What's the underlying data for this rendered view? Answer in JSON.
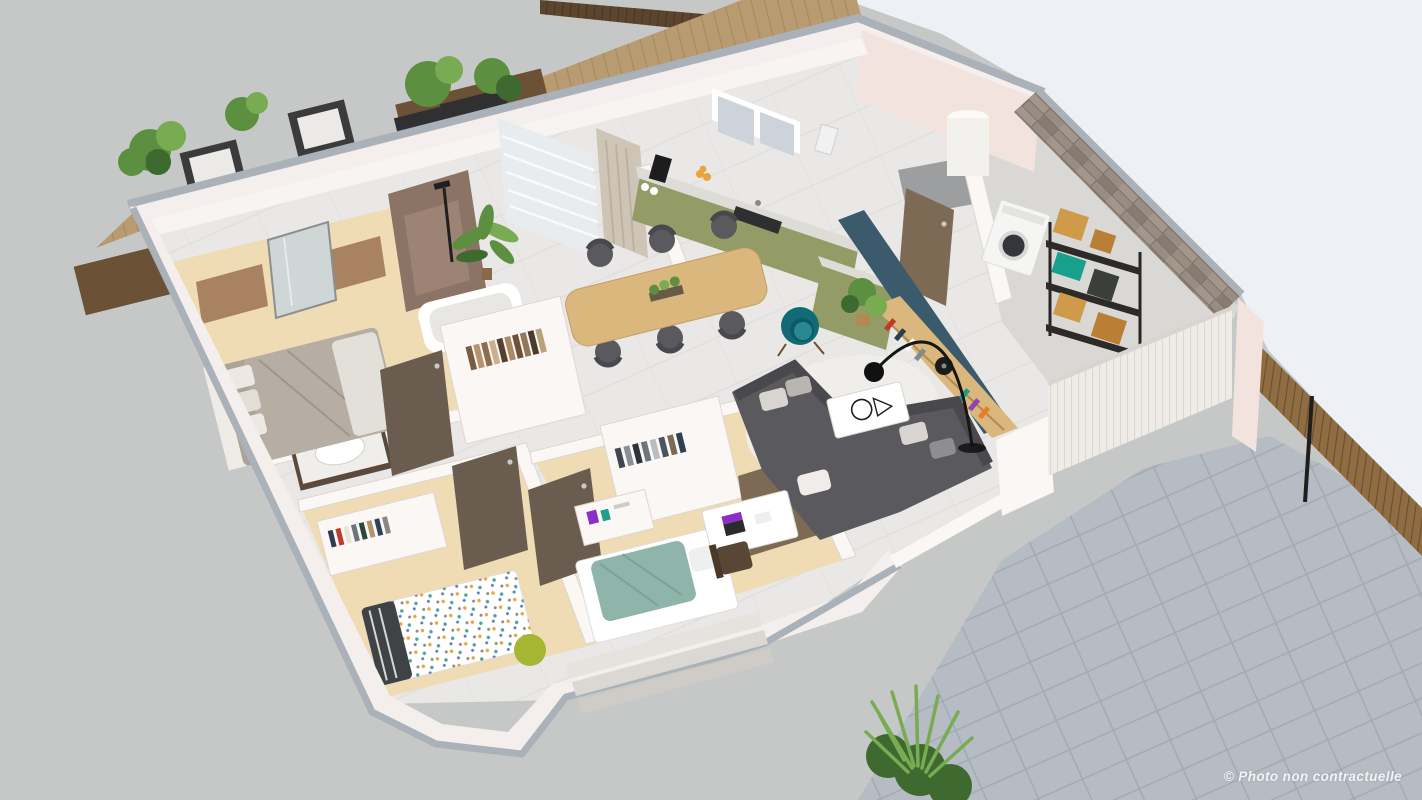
{
  "image": {
    "type": "isometric-3d-floor-plan-render",
    "description": "Aerial 3D cutaway render of a furnished single-storey home with wooden terrace, interior rooms, laundry area and stone-tiled patio"
  },
  "watermark": {
    "text": "© Photo non contractuelle",
    "color": "#ffffff"
  },
  "palette": {
    "concrete": "#c6c8c7",
    "patio": "#b6bcc4",
    "grout": "#a3aab4",
    "sky": "#edf1f6",
    "deckwood": "#b89b70",
    "fencedark": "#5c452e",
    "fenceright": "#8f6c42",
    "wallpink": "#f3e3de",
    "wallwhite": "#f4efec",
    "intwall": "#faf7f4",
    "wallshadow": "#ded7d1",
    "coping": "#aab1b8",
    "marble": "#e9e8e6",
    "wood": "#efdbb4",
    "brown": "#a98263",
    "showerbrown": "#8b7365",
    "door": "#6a5c4f",
    "doorbrown": "#7d6a55",
    "green": "#939c66",
    "countertop": "#dedcd6",
    "teal": "#3b5a6c",
    "oak": "#d9b77d",
    "rug": "#f0eeea",
    "sofagray": "#5a595d",
    "sofadark": "#49484c",
    "armteal": "#106b77",
    "bedgray": "#aca49b",
    "tealblanket": "#8fb5ab",
    "machine": "#f5f5f4",
    "shelfblack": "#2c2b2a",
    "box": "#cf9a4a",
    "box2": "#b97f35",
    "crate": "#17a08c",
    "stone": "#988d82",
    "plant": "#5c8f3f",
    "plantlight": "#79ab53",
    "plantdark": "#3f6a2f",
    "lime": "#a6b632",
    "purple": "#8b2fc9",
    "orange": "#e9a43c"
  },
  "scene": {
    "rooms": [
      "terrace-deck",
      "master-bedroom",
      "bathroom",
      "hallway-closets",
      "kids-bedroom",
      "office-bedroom",
      "kitchen",
      "dining-area",
      "living-room",
      "entry",
      "laundry-storage",
      "patio"
    ],
    "objects": [
      "hedge-bushes",
      "outdoor-armchairs",
      "sun-loungers",
      "double-bed",
      "shower",
      "bathtub",
      "sink-vanity",
      "wardrobes",
      "interior-doors",
      "kitchen-cabinets",
      "coffee-machine",
      "fruit-bowl",
      "kitchen-window",
      "dining-table",
      "dining-chairs",
      "corner-sofa",
      "round-rug",
      "coffee-table",
      "teal-armchair",
      "arc-floor-lamp",
      "bookshelf",
      "monstera-plant",
      "water-heater-column",
      "washing-machine",
      "metal-shelving",
      "cardboard-boxes",
      "single-bed-dotted",
      "lime-pouf",
      "teal-bed",
      "desk-with-laptop",
      "desk-chair",
      "stone-accent-wall",
      "white-slat-wall",
      "wooden-fences",
      "patio-shrub"
    ]
  }
}
